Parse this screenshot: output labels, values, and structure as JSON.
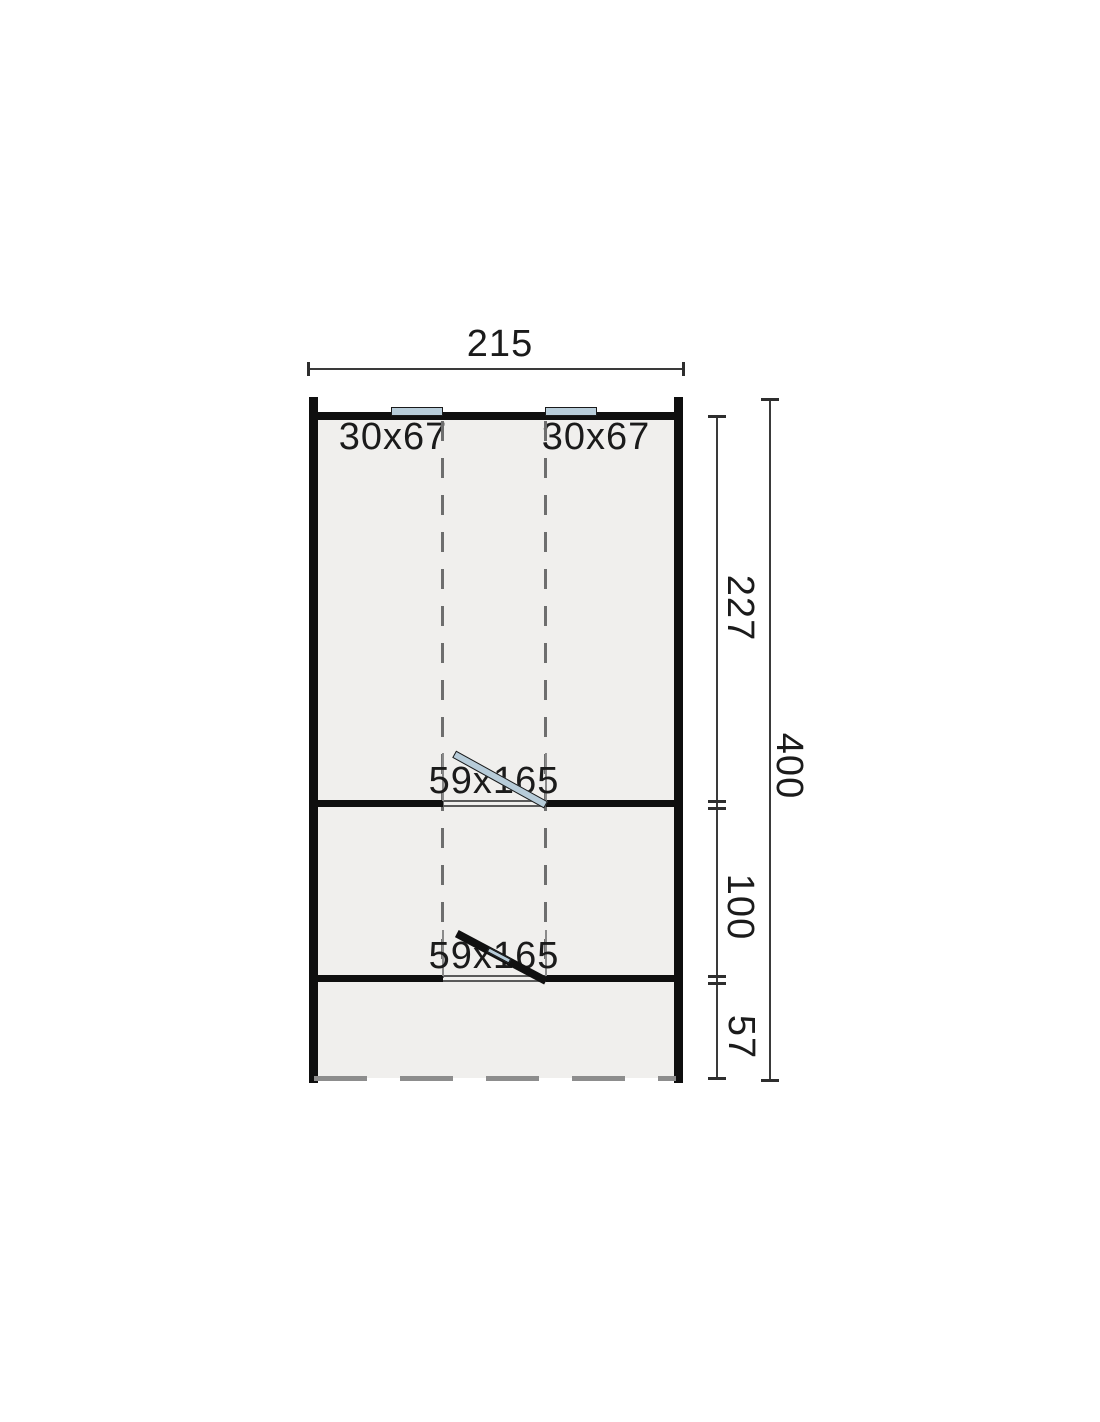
{
  "plan": {
    "type": "floor-plan-top-view",
    "dimensions": {
      "width": "215",
      "total_height": "400",
      "room_main": "227",
      "room_middle": "100",
      "porch": "57"
    },
    "windows": [
      {
        "size": "30x67"
      },
      {
        "size": "30x67"
      }
    ],
    "doors": [
      {
        "size": "59x165"
      },
      {
        "size": "59x165"
      }
    ],
    "colors": {
      "wall": "#0f0f0f",
      "floor": "#f0efed",
      "glazing": "#b7ccd9",
      "dashed_guide": "#6e6e6e",
      "open_edge_dash": "#8d8d8d",
      "dimension_line": "#3a3a3a",
      "text": "#1b1b1b",
      "background": "#ffffff"
    }
  }
}
